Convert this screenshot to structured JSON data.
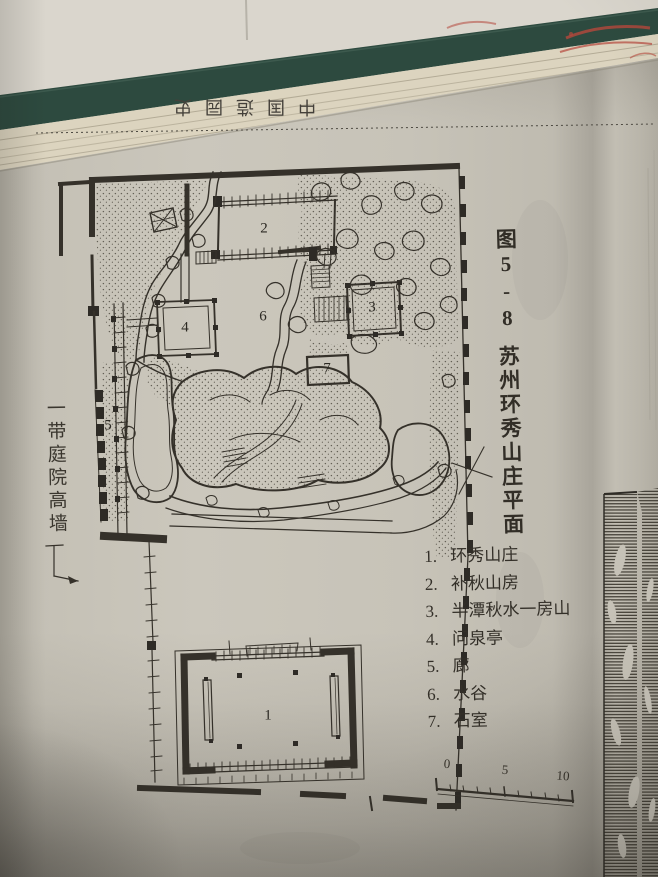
{
  "photo": {
    "wall_color": "#dad6cd",
    "book_cover_color": "#2d4a3f",
    "page_edge_color": "#dcd4bf",
    "page_color": "#c7c3b8",
    "ink_color": "#35312a",
    "red_mark_color": "#b5473c"
  },
  "book": {
    "running_head": "中国造园史"
  },
  "figure": {
    "number": "图5-8",
    "title": "苏州环秀山庄平面",
    "wall_note": "一带庭院高墙",
    "legend": [
      {
        "num": "1.",
        "label": "环秀山庄"
      },
      {
        "num": "2.",
        "label": "补秋山房"
      },
      {
        "num": "3.",
        "label": "半潭秋水一房山"
      },
      {
        "num": "4.",
        "label": "问泉亭"
      },
      {
        "num": "5.",
        "label": "廊"
      },
      {
        "num": "6.",
        "label": "水谷"
      },
      {
        "num": "7.",
        "label": "石室"
      }
    ],
    "markers": [
      "1",
      "2",
      "3",
      "4",
      "5",
      "6",
      "7"
    ],
    "scale": {
      "start": "0",
      "mid": "5",
      "end": "10"
    }
  }
}
